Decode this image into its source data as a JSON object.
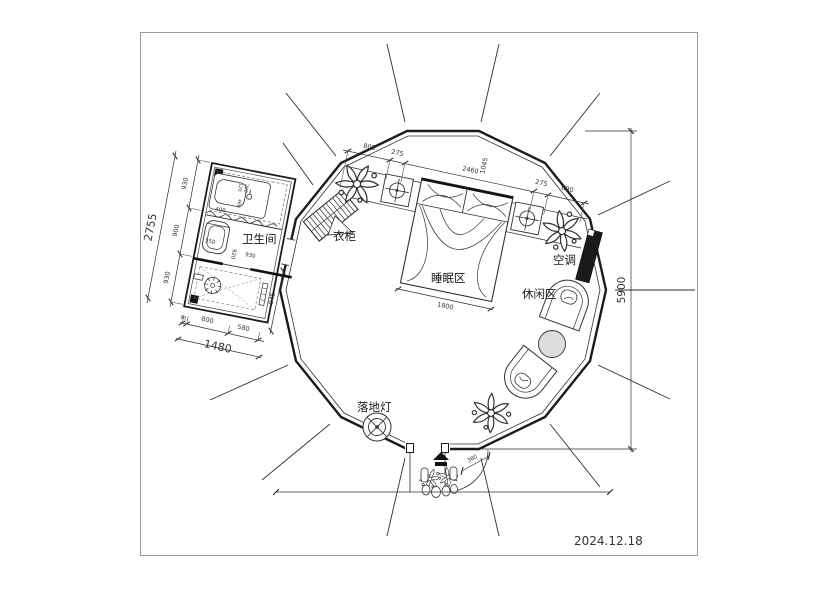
{
  "date": "2024.12.18",
  "rooms": {
    "bathroom": "卫生间",
    "sleeping": "睡眠区",
    "leisure": "休闲区"
  },
  "items": {
    "wardrobe": "衣柜",
    "air_conditioner": "空调",
    "floor_lamp": "落地灯"
  },
  "dims": {
    "top": {
      "a": "805",
      "b": "275",
      "c": "2460",
      "c2": "1045",
      "d": "275",
      "e": "690"
    },
    "left": {
      "a": "930",
      "b": "900",
      "c": "930",
      "total": "2755"
    },
    "bath_bottom": {
      "a": "90",
      "b": "800",
      "c": "580",
      "total": "1480"
    },
    "bath_right": "945",
    "bath_inner": {
      "toilet": "550",
      "w1": "920",
      "w2": "930",
      "v1": "400",
      "v2": "460",
      "v3": "120",
      "v4": "290"
    },
    "room_height": "5900",
    "bed_width": "1800",
    "door": "380"
  }
}
